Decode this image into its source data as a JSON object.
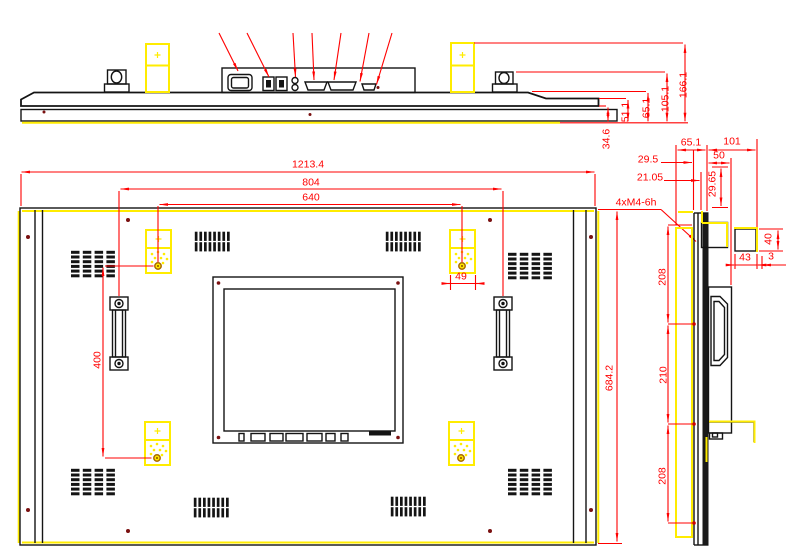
{
  "drawing": {
    "title": "Industrial LCD monitor outline drawing",
    "colors": {
      "dimension_red": "#ff0000",
      "highlight_yellow": "#ffec00",
      "outline_black": "#141414"
    },
    "top_view": {
      "dims": {
        "d34_6": "34.6",
        "d51_1": "51.1",
        "d65_1": "65.1",
        "d105_1": "105.1",
        "d166_1": "166.1"
      }
    },
    "back_view": {
      "dims": {
        "overall_width": "1213.4",
        "handle_span": "804",
        "mount_span_h": "640",
        "mount_span_v": "400",
        "overall_height": "684.2",
        "speaker_box": "49",
        "thread_callout": "4xM4-6h"
      }
    },
    "side_view": {
      "dims": {
        "depth_panel": "65.1",
        "depth_overall": "101",
        "d29_5": "29.5",
        "d50": "50",
        "d21_05": "21.05",
        "d29_65": "29.65",
        "pitch_top": "208",
        "pitch_mid": "210",
        "pitch_bottom": "208",
        "d43": "43",
        "d3": "3",
        "d40": "40"
      }
    }
  }
}
